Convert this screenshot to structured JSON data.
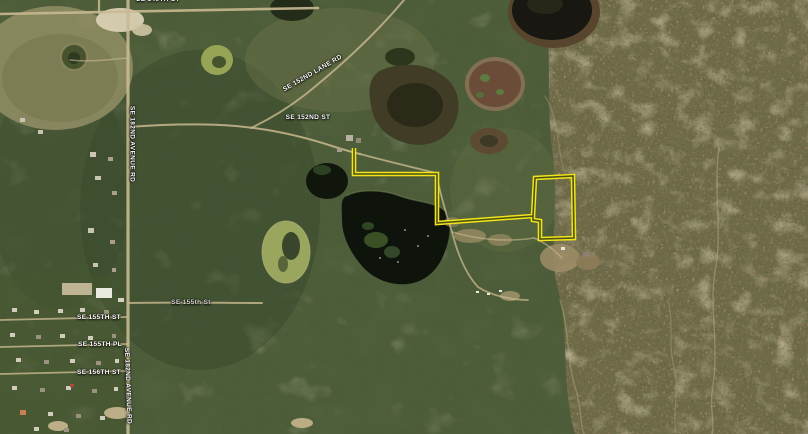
{
  "map": {
    "kind": "satellite-aerial-view",
    "parcel_outline": {
      "color": "#f2e418",
      "shape": "flag-lot-with-rectangular-parcel",
      "vertices": [
        [
          354,
          148
        ],
        [
          354,
          174
        ],
        [
          437,
          174
        ],
        [
          437,
          223
        ],
        [
          533,
          216
        ],
        [
          535,
          178
        ],
        [
          573,
          176
        ],
        [
          574,
          238
        ],
        [
          540,
          239
        ],
        [
          540,
          221
        ],
        [
          533,
          220
        ]
      ]
    },
    "road_labels": [
      {
        "text": "SE 149TH ST"
      },
      {
        "text": "SE 152ND LANE RD"
      },
      {
        "text": "SE 152ND ST"
      },
      {
        "text": "SE 182ND AVENUE RD"
      },
      {
        "text": "SE 155th St"
      },
      {
        "text": "SE 155TH ST"
      },
      {
        "text": "SE 155TH PL"
      },
      {
        "text": "SE 156TH ST"
      },
      {
        "text": "SE 182ND AVENUE RD"
      }
    ],
    "colors": {
      "forest_green": "#4d5c39",
      "scrub_olive": "#6f6b49",
      "water_dark": "#191711",
      "road_tan": "#c9b991",
      "label_text": "#ffffff"
    }
  }
}
